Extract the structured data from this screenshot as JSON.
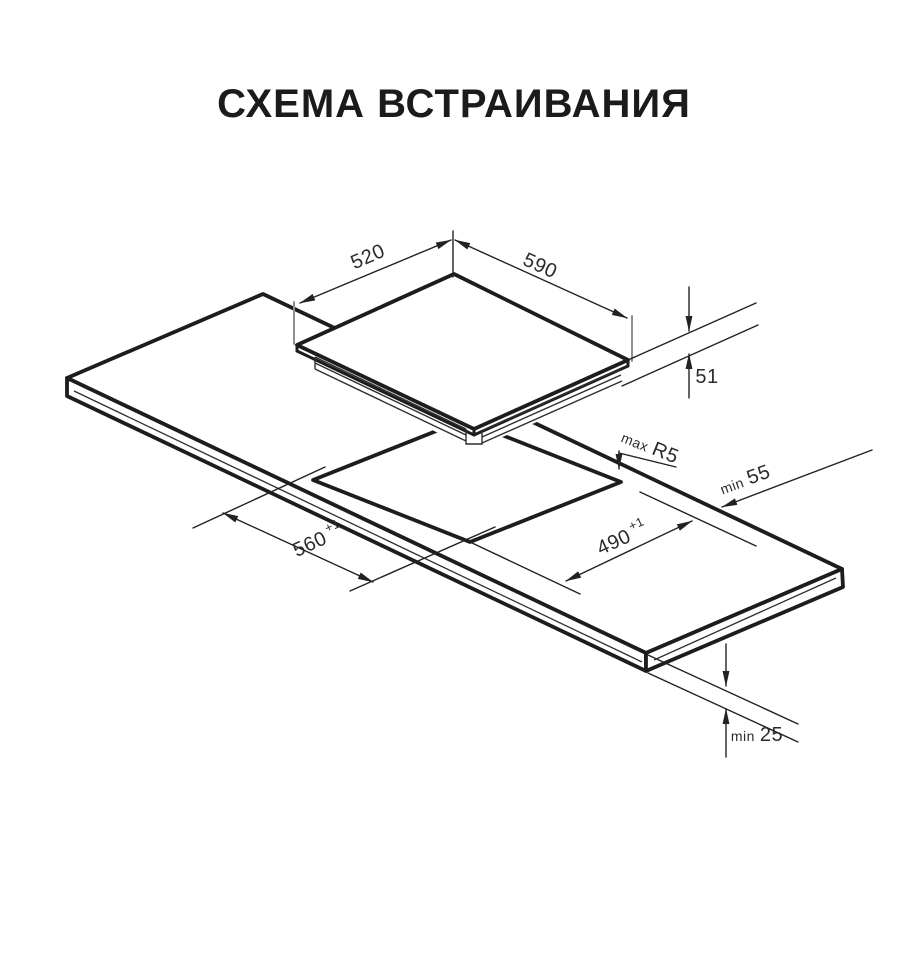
{
  "title": "СХЕМА ВСТРАИВАНИЯ",
  "diagram": {
    "labels": {
      "hob_top_depth": {
        "value": "520"
      },
      "hob_top_width": {
        "value": "590"
      },
      "hob_height": {
        "value": "51"
      },
      "cutout_corner_radius": {
        "prefix": "max",
        "value": "R5"
      },
      "rear_clearance": {
        "prefix": "min",
        "value": "55"
      },
      "cutout_depth": {
        "value": "490",
        "tolerance": "+1"
      },
      "cutout_width": {
        "value": "560",
        "tolerance": "+1"
      },
      "worktop_thickness": {
        "prefix": "min",
        "value": "25"
      }
    }
  }
}
